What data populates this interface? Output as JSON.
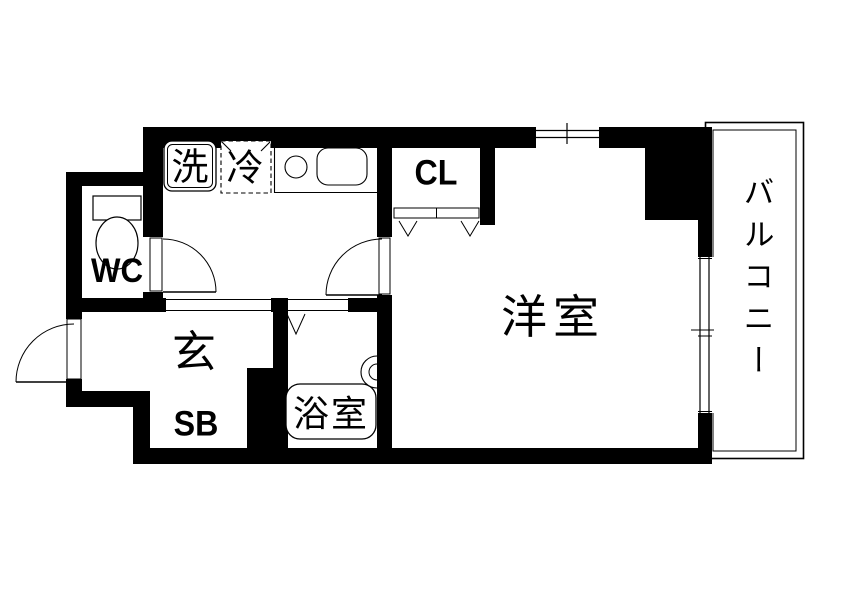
{
  "title": "apartment-floor-plan",
  "colors": {
    "wall": "#000000",
    "background": "#ffffff",
    "line": "#000000"
  },
  "rooms": {
    "wc": {
      "label": "WC"
    },
    "closet": {
      "label": "CL"
    },
    "genkan": {
      "label": "玄"
    },
    "shoe_box": {
      "label": "SB"
    },
    "bathroom": {
      "label": "浴室"
    },
    "western_room": {
      "label": "洋室"
    },
    "balcony": {
      "label": "バルコニー"
    }
  },
  "fixtures": {
    "washing_machine": {
      "label": "洗"
    },
    "refrigerator": {
      "label": "冷"
    }
  }
}
